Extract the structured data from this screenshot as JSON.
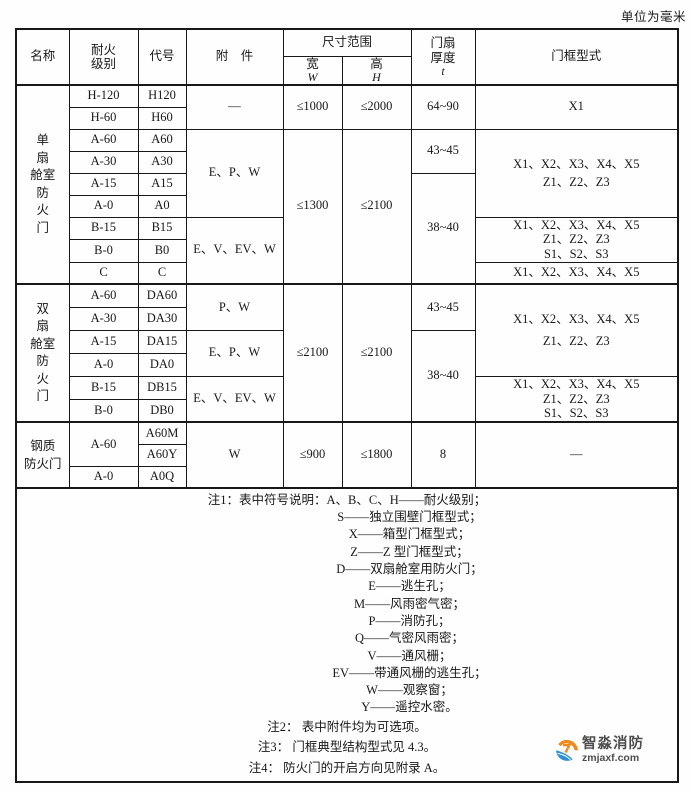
{
  "page": {
    "unit_label": "单位为毫米"
  },
  "header": {
    "name": "名称",
    "fire_rating_lines": [
      "耐火",
      "级别"
    ],
    "code": "代号",
    "accessory": "附　件",
    "size_range": "尺寸范围",
    "width_label": "宽",
    "width_symbol": "W",
    "height_label": "高",
    "height_symbol": "H",
    "thickness_lines": [
      "门扇",
      "厚度"
    ],
    "thickness_symbol": "t",
    "frame_type": "门框型式"
  },
  "group1": {
    "name_lines": [
      "单",
      "扇",
      "舱室",
      "防",
      "火",
      "门"
    ],
    "ratings": [
      "H-120",
      "H-60",
      "A-60",
      "A-30",
      "A-15",
      "A-0",
      "B-15",
      "B-0",
      "C"
    ],
    "codes": [
      "H120",
      "H60",
      "A60",
      "A30",
      "A15",
      "A0",
      "B15",
      "B0",
      "C"
    ],
    "accessories": [
      "—",
      "E、P、W",
      "E、V、EV、W"
    ],
    "widths": [
      "≤1000",
      "≤1300"
    ],
    "heights": [
      "≤2000",
      "≤2100"
    ],
    "thicknesses": [
      "64~90",
      "43~45",
      "38~40"
    ],
    "frames": [
      [
        "X1"
      ],
      [
        "X1、X2、X3、X4、X5",
        "Z1、Z2、Z3"
      ],
      [
        "X1、X2、X3、X4、X5",
        "Z1、Z2、Z3",
        "S1、S2、S3"
      ],
      [
        "X1、X2、X3、X4、X5"
      ]
    ]
  },
  "group2": {
    "name_lines": [
      "双",
      "扇",
      "舱室",
      "防",
      "火",
      "门"
    ],
    "ratings": [
      "A-60",
      "A-30",
      "A-15",
      "A-0",
      "B-15",
      "B-0"
    ],
    "codes": [
      "DA60",
      "DA30",
      "DA15",
      "DA0",
      "DB15",
      "DB0"
    ],
    "accessories": [
      "P、W",
      "E、P、W",
      "E、V、EV、W"
    ],
    "widths": [
      "≤2100"
    ],
    "heights": [
      "≤2100"
    ],
    "thicknesses": [
      "43~45",
      "38~40"
    ],
    "frames": [
      [
        "X1、X2、X3、X4、X5",
        "Z1、Z2、Z3"
      ],
      [
        "X1、X2、X3、X4、X5",
        "Z1、Z2、Z3",
        "S1、S2、S3"
      ]
    ]
  },
  "group3": {
    "name_lines": [
      "钢质",
      "防火门"
    ],
    "ratings": [
      "A-60",
      "A-0"
    ],
    "codes": [
      "A60M",
      "A60Y",
      "A0Q"
    ],
    "accessory": "W",
    "width": "≤900",
    "height": "≤1800",
    "thickness": "8",
    "frame": "—"
  },
  "notes": {
    "n1_label": "注1：",
    "n1_intro": "表中符号说明：",
    "symbols": [
      "A、B、C、H——耐火级别；",
      "S——独立围壁门框型式；",
      "X——箱型门框型式；",
      "Z——Z 型门框型式；",
      "D——双扇舱室用防火门；",
      "E——逃生孔；",
      "M——风雨密气密；",
      "P——消防孔；",
      "Q——气密风雨密；",
      "V——通风栅；",
      "EV——带通风栅的逃生孔；",
      "W——观察窗；",
      "Y——遥控水密。"
    ],
    "n2_label": "注2：",
    "n2_text": "表中附件均为可选项。",
    "n3_label": "注3：",
    "n3_text": "门框典型结构型式见 4.3。",
    "n4_label": "注4：",
    "n4_text": "防火门的开启方向见附录 A。"
  },
  "logo": {
    "brand": "智淼消防",
    "domain": "zmjaxf.com",
    "orange": "#f2891c",
    "blue": "#2d8fd6"
  }
}
